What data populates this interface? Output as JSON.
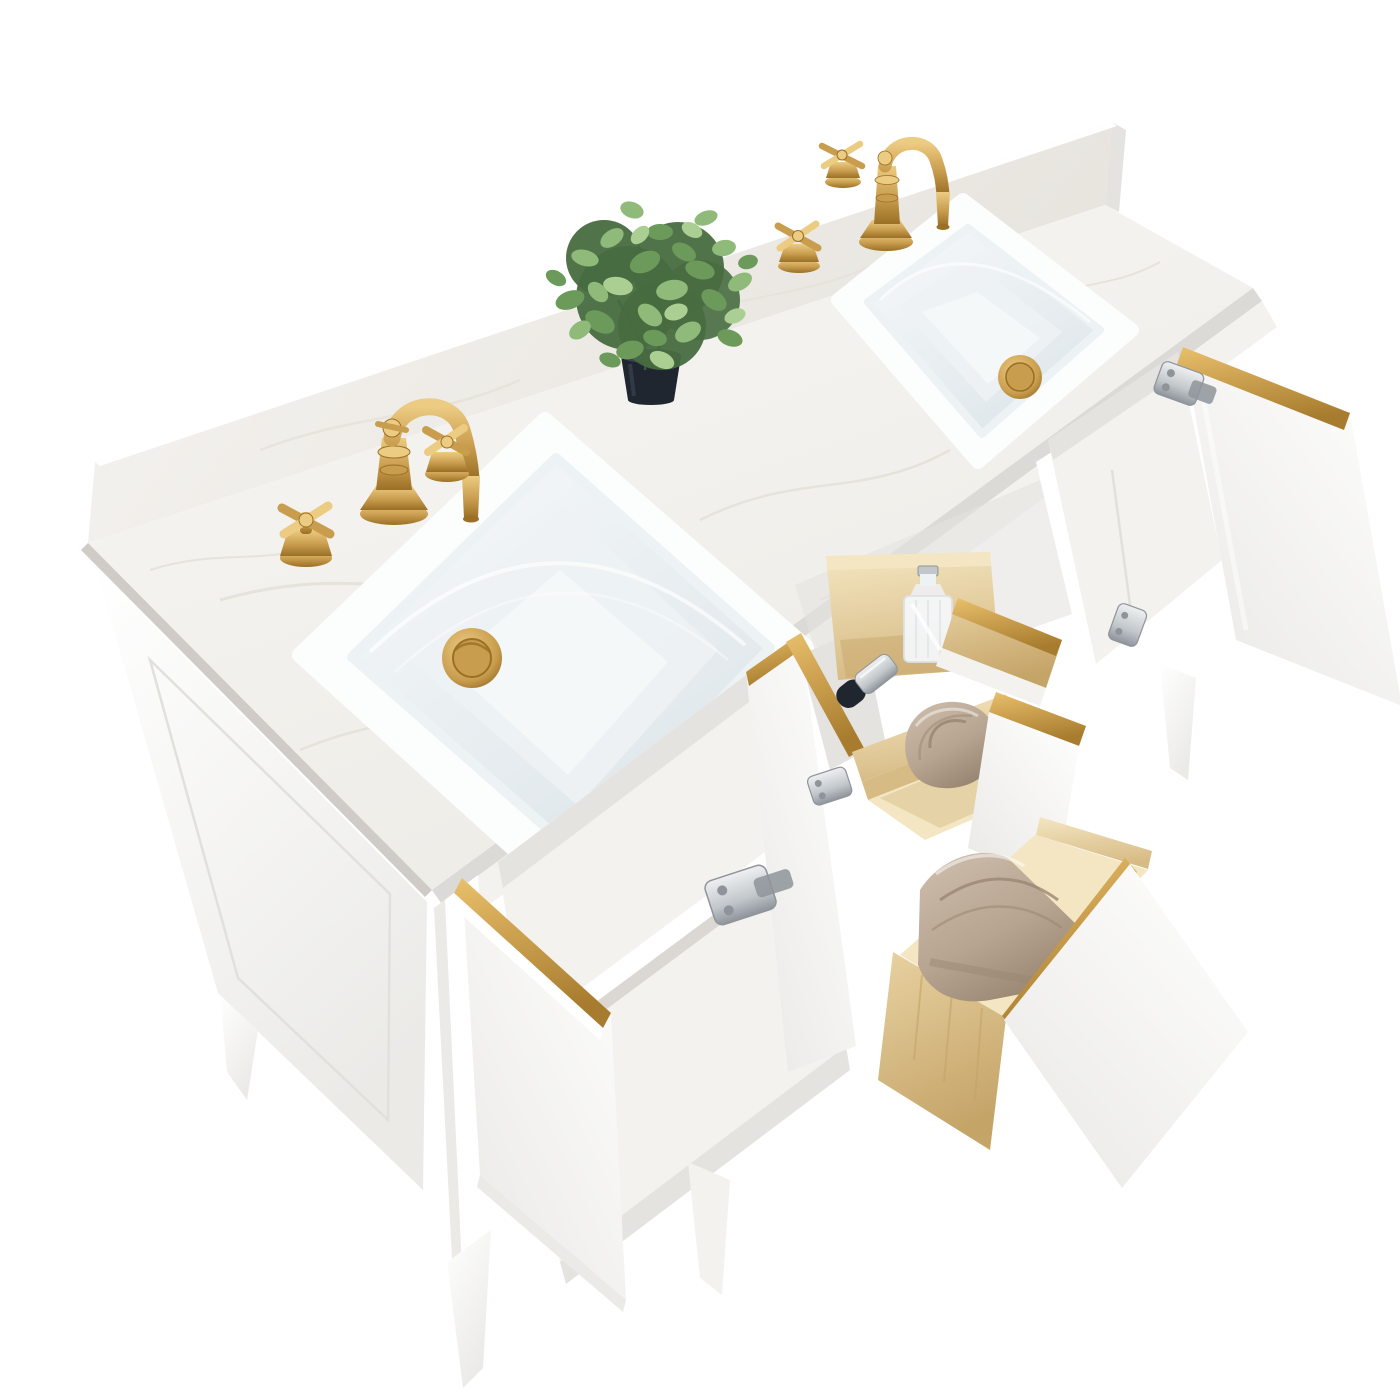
{
  "meta": {
    "kind": "product-photo",
    "subject": "white double-sink bathroom vanity with brushed-gold faucets, open doors and open drawers, on plain white background"
  },
  "scene": {
    "background": "#ffffff",
    "objects": [
      {
        "name": "countertop",
        "look": "white engineered marble slab with faint beige veining and raised backsplash"
      },
      {
        "name": "left-sink",
        "look": "undermount rectangular white ceramic sink with gold pop-up drain"
      },
      {
        "name": "right-sink",
        "look": "undermount rectangular white ceramic sink with gold pop-up drain"
      },
      {
        "name": "left-faucet",
        "look": "widespread brushed-gold faucet, curved spout, two cross handles"
      },
      {
        "name": "right-faucet",
        "look": "widespread brushed-gold faucet, curved spout, two cross handles"
      },
      {
        "name": "plant",
        "look": "artificial green eucalyptus plant in small black round pot"
      },
      {
        "name": "cabinet",
        "look": "white shaker cabinet, gold edge trim strips, tapered white legs, chrome concealed hinges"
      },
      {
        "name": "left-door",
        "state": "open"
      },
      {
        "name": "middle-door",
        "state": "open"
      },
      {
        "name": "right-door",
        "state": "open"
      },
      {
        "name": "top-drawer",
        "state": "open tilt-out tray",
        "contents": [
          "glass perfume bottle",
          "black-and-chrome cosmetic bottle"
        ]
      },
      {
        "name": "middle-drawer",
        "state": "open",
        "contents": [
          "rolled beige towel"
        ]
      },
      {
        "name": "bottom-drawer",
        "state": "open",
        "contents": [
          "folded beige towel"
        ]
      },
      {
        "name": "drawer-boxes",
        "look": "natural pine wood interiors"
      }
    ],
    "counts": {
      "sinks": 2,
      "faucets": 2,
      "faucet_handles": 4,
      "drains": 2,
      "open_doors": 3,
      "open_drawers": 3,
      "towels": 2,
      "visible_hinges": 4,
      "visible_legs": 4,
      "plants": 1
    }
  },
  "colors": {
    "bg": "#ffffff",
    "marbleLight": "#f8f7f4",
    "marbleMid": "#edebe6",
    "marbleVein": "#e3ded4",
    "counterEdge": "#dcdad6",
    "counterEdgeDark": "#cfccc8",
    "splashLight": "#f6f4f1",
    "splashDark": "#e7e4de",
    "goldLight": "#eccb82",
    "gold": "#c99d4e",
    "goldDark": "#9a7026",
    "goldStripLight": "#e9c06c",
    "goldStripDark": "#a87c2e",
    "sinkWhite": "#fcfdfd",
    "basinLight": "#f5f8f9",
    "basinShade": "#dce4e9",
    "basinInner": "#edf2f4",
    "panelWhite": "#ffffff",
    "panelShade": "#ebeae7",
    "panelLine": "#e2e0dc",
    "interior": "#f3f2ef",
    "interiorShade": "#e5e3df",
    "interiorDark": "#dbd8d3",
    "woodLight": "#f4e6c2",
    "wood": "#e8d2a2",
    "woodDark": "#d7bb85",
    "woodShade": "#c5a468",
    "towelLight": "#cfbfae",
    "towel": "#b7a491",
    "towelDark": "#9a8773",
    "chromeLight": "#eef0f2",
    "chrome": "#c2c7cb",
    "chromeDark": "#8e949a",
    "potBlack": "#20262f",
    "potHighlight": "#3a434f",
    "leafDark": "#486c40",
    "leaf": "#6b9a5a",
    "leafLight": "#8fba7a",
    "leafPale": "#abcf92"
  }
}
